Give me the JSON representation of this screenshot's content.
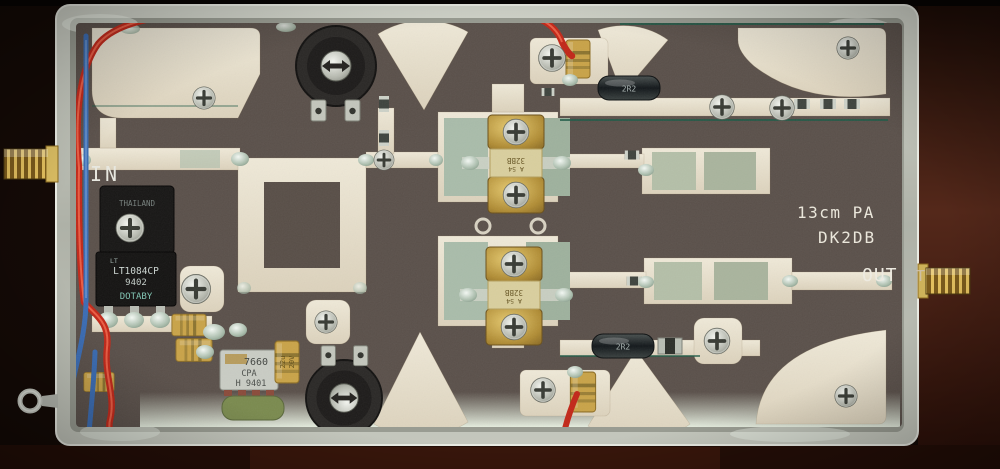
{
  "photo": {
    "subject": "13 cm band RF power amplifier PCB mounted in an open tinplate enclosure, photographed from above",
    "labels": {
      "input": "IN",
      "output": "OUT",
      "output_side": "T",
      "silkscreen_line1": "13cm PA",
      "silkscreen_line2": "DK2DB"
    },
    "components": {
      "regulator": {
        "brand_mark": "LT",
        "origin": "THAILAND",
        "part": "LT1084CP",
        "date_code": "9402",
        "lot_code": "DOTABY"
      },
      "charge_pump": {
        "part": "7660",
        "suffix": "CPA",
        "lot": "H 9401"
      },
      "rf_transistor": {
        "mark_top": "A 54",
        "mark_bottom": "32BB"
      },
      "inductor_value": "2R2",
      "tantalum_value": "22u",
      "tantalum_voltage": "20V"
    },
    "colors": {
      "enclosure": "#b2b5ab",
      "pcb_substrate": "#5a504a",
      "copper_trace": "#e7e0cd",
      "solder_patch": "#a9bcaa",
      "gold_connector": "#d9b44e",
      "red_wire": "#c22718",
      "blue_wire": "#3a6cb4",
      "tantalum": "#c9a348",
      "background_wood": "#2a1009"
    }
  }
}
